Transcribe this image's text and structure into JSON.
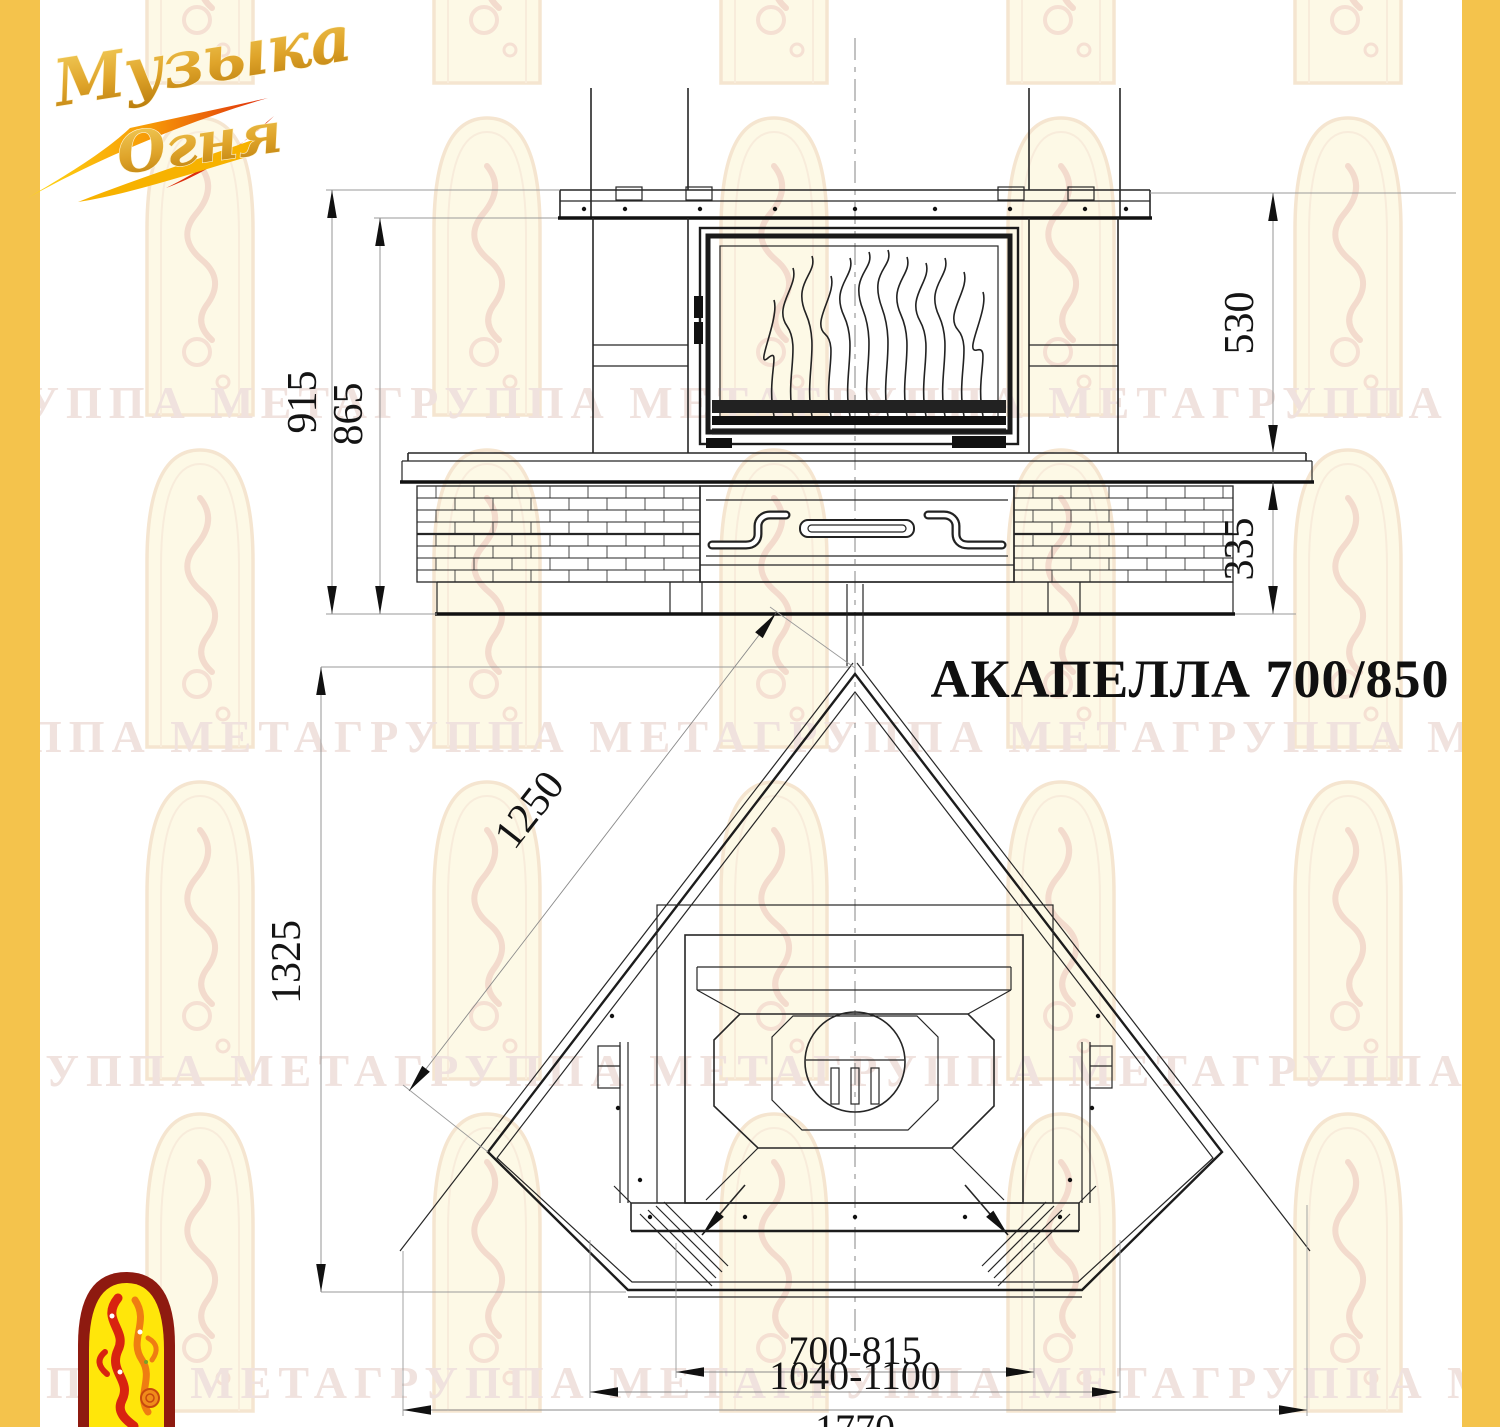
{
  "page": {
    "background": "#FFFFFF",
    "band_color": "#F4C34C"
  },
  "brand": {
    "logo_line1": "Музыка",
    "logo_line2": "Огня"
  },
  "watermark": {
    "row_text": "ГРУППА МЕТАГРУППА МЕТАГРУППА МЕТАГРУППА МЕТАГРУППА МЕТА",
    "color": "#F0E2DE"
  },
  "drawing": {
    "title": "АКАПЕЛЛА 700/850",
    "front_view": {
      "total_height": "915",
      "body_height": "865",
      "firebox_height": "530",
      "plinth_height": "335"
    },
    "plan_view": {
      "side_length": "1250",
      "depth": "1325",
      "opening_width": "700-815",
      "hearth_width": "1040-1100",
      "overall_width": "1770"
    }
  }
}
